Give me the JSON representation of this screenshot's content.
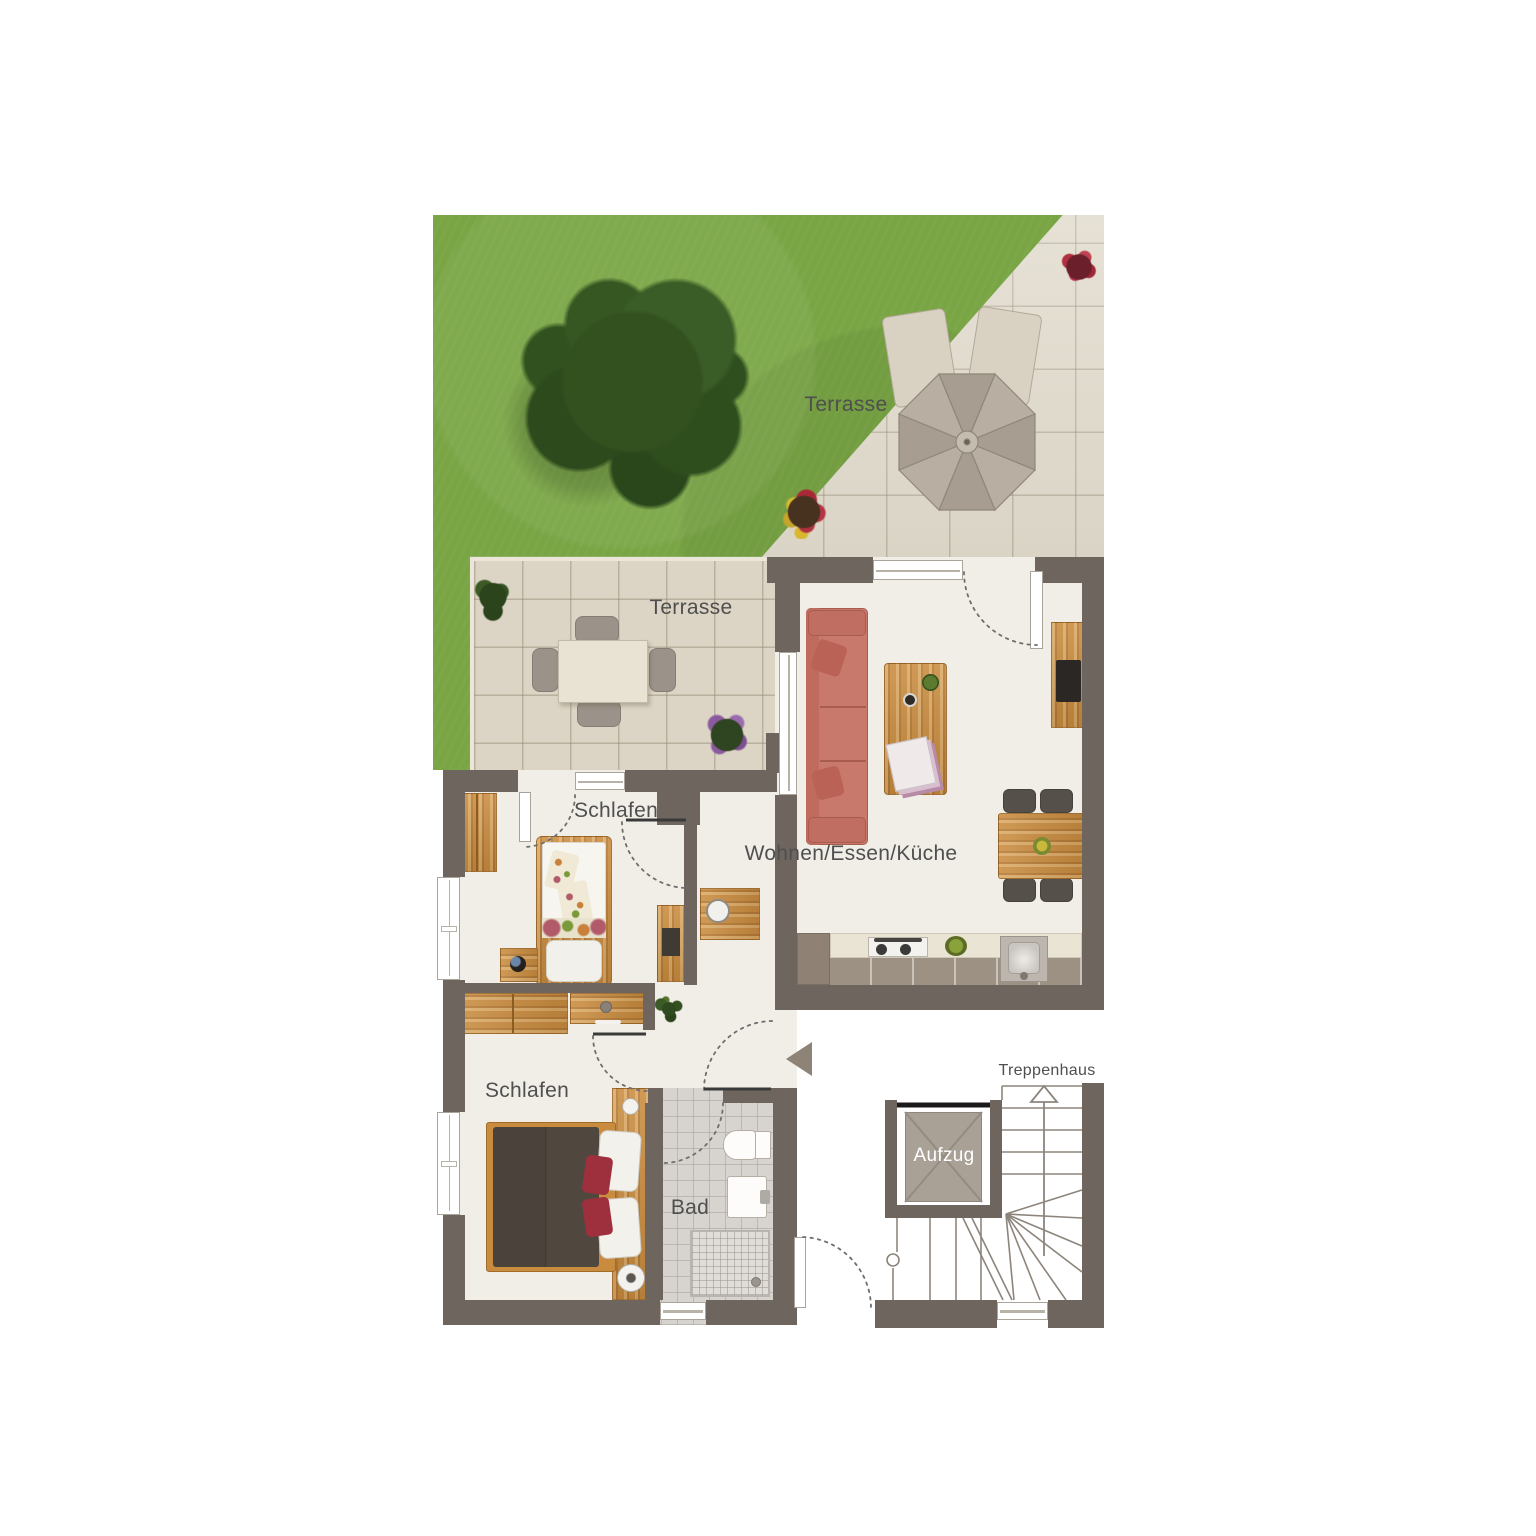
{
  "rooms": {
    "terrace_upper": {
      "label": "Terrasse"
    },
    "terrace_lower": {
      "label": "Terrasse"
    },
    "living": {
      "label": "Wohnen/Essen/Küche"
    },
    "bedroom_upper": {
      "label": "Schlafen"
    },
    "bedroom_lower": {
      "label": "Schlafen"
    },
    "bathroom": {
      "label": "Bad"
    },
    "stairwell": {
      "label": "Treppenhaus"
    },
    "elevator": {
      "label": "Aufzug"
    }
  },
  "colors": {
    "wall": "#6f655f",
    "grass": "#79a544",
    "tile_light": "#e1dbcc",
    "tile_mid": "#dcd4c4",
    "floor": "#f0eee7",
    "bath_floor": "#d7d3cf",
    "wood": "#c98c3f",
    "sofa": "#c9796c",
    "accent_red": "#9e2f3d",
    "elevator_cab": "#a9a096",
    "label_text": "#4f4f4f"
  }
}
